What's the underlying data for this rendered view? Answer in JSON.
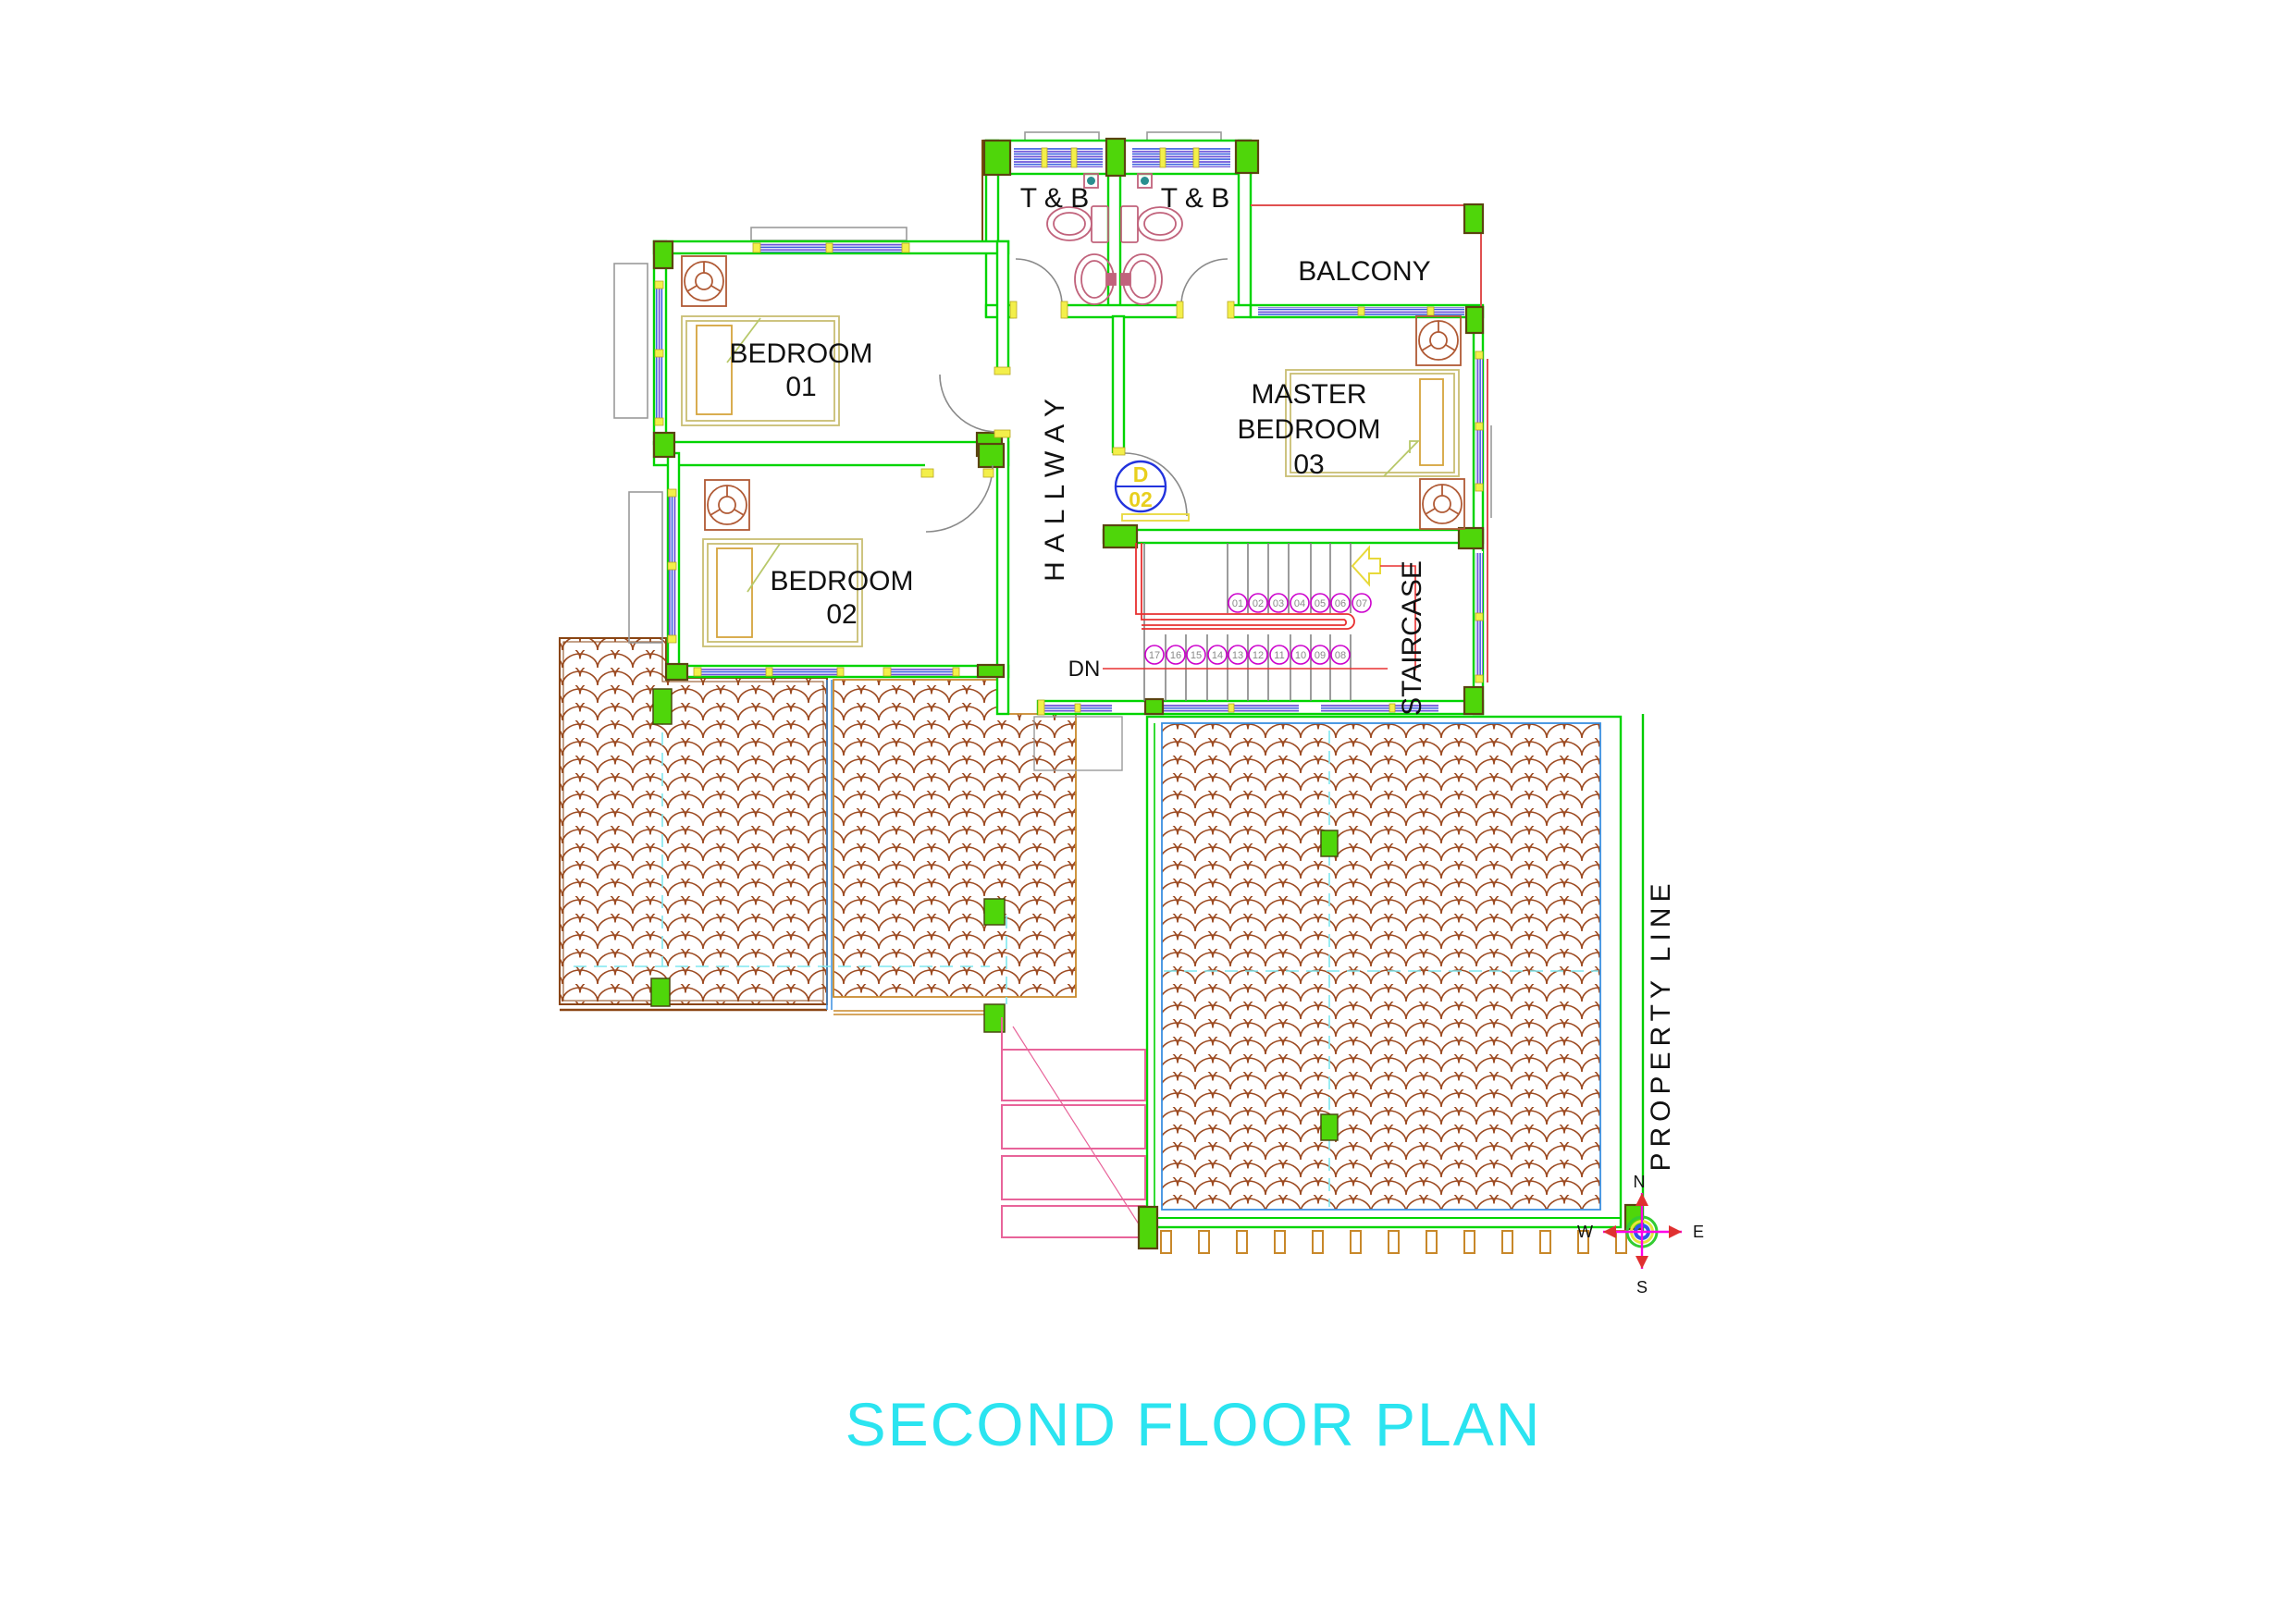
{
  "title": {
    "text": "SECOND FLOOR PLAN",
    "color": "#2be4f0"
  },
  "rooms": {
    "tb_left": {
      "label": "T & B"
    },
    "tb_right": {
      "label": "T & B"
    },
    "balcony": {
      "label": "BALCONY"
    },
    "bedroom1": {
      "line1": "BEDROOM",
      "line2": "01"
    },
    "bedroom2": {
      "line1": "BEDROOM",
      "line2": "02"
    },
    "master": {
      "line1": "MASTER",
      "line2": "BEDROOM",
      "line3": "03"
    },
    "hallway": {
      "label": "HALLWAY"
    },
    "staircase": {
      "label": "STAIRCASE"
    }
  },
  "stairs": {
    "dn_label": "DN",
    "top": [
      "01",
      "02",
      "03",
      "04",
      "05",
      "06",
      "07"
    ],
    "bottom": [
      "17",
      "16",
      "15",
      "14",
      "13",
      "12",
      "11",
      "10",
      "09",
      "08"
    ]
  },
  "door_tag": {
    "letter": "D",
    "number": "02"
  },
  "property_line_label": "PROPERTY LINE",
  "compass": {
    "n": "N",
    "e": "E",
    "s": "S",
    "w": "W"
  },
  "colors": {
    "wall_green": "#00d400",
    "post_green": "#4fd60a",
    "window_violet": "#6a4fd8",
    "window_blue": "#2d55dd",
    "roof_tile_brown": "#9c4a21",
    "roof_border_brown": "#8a4513",
    "accent_red": "#e03030",
    "handrail_red": "#e83030",
    "stair_magenta": "#cc00cc",
    "compass_magenta": "#ff00e8",
    "cyan_dash": "#7fe7ef",
    "yellow": "#f3ef4a",
    "title_cyan": "#2be4f0",
    "fixture_pink": "#c1637c",
    "bed_tan": "#c9bd72",
    "pillow_orange": "#d5a43c",
    "fan_brown": "#b05a35",
    "property_green": "#00cc00"
  }
}
